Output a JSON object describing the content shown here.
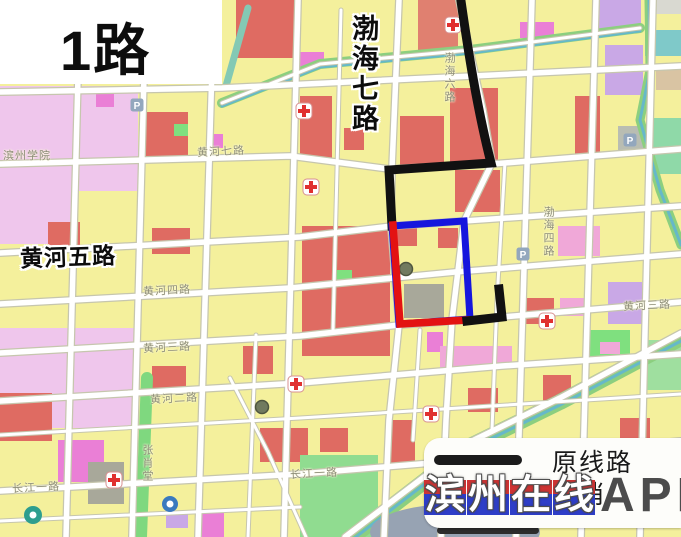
{
  "page": {
    "title": "1路"
  },
  "map": {
    "bold_labels": {
      "bohai7": "渤海七路",
      "huanghe5": "黄河五路"
    },
    "minor_labels": [
      {
        "id": "binzhou-college",
        "text": "滨州学院"
      },
      {
        "id": "huanghe7",
        "text": "黄河七路"
      },
      {
        "id": "huanghe4",
        "text": "黄河四路"
      },
      {
        "id": "huanghe3-left",
        "text": "黄河三路"
      },
      {
        "id": "huanghe2",
        "text": "黄河二路"
      },
      {
        "id": "changjiang1-left",
        "text": "长江一路"
      },
      {
        "id": "changjiang1-mid",
        "text": "长江一路"
      },
      {
        "id": "huanghe3-right",
        "text": "黄河三路"
      },
      {
        "id": "bohai4",
        "text": "渤海四路"
      },
      {
        "id": "bohai6",
        "text": "渤海六路"
      },
      {
        "id": "zhangxiaotang",
        "text": "张肖堂"
      }
    ],
    "parking_glyph": "P"
  },
  "legend": {
    "original_route_label": "原线路",
    "second_row_label": "取消"
  },
  "watermark": {
    "brand_chars": [
      "滨",
      "州",
      "在",
      "线"
    ],
    "suffix": "APP"
  },
  "colors": {
    "route_original": "#111111",
    "route_red": "#e31212",
    "route_blue": "#1616dd"
  }
}
